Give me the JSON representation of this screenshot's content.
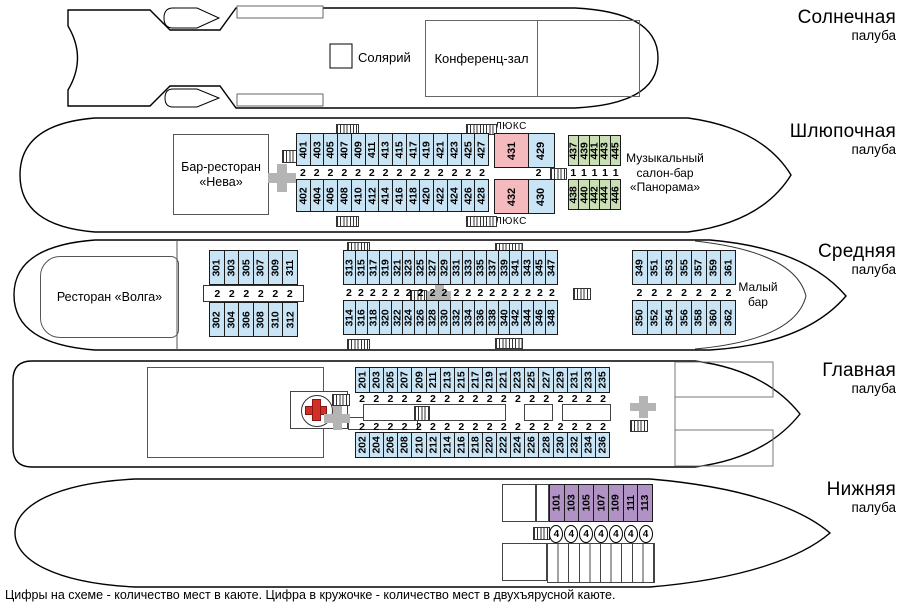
{
  "caption": "Цифры на схеме - количество мест в каюте. Цифра в кружочке - количество мест в двухъярусной каюте.",
  "decks": {
    "sun": {
      "name": "Солнечная",
      "sub": "палуба",
      "solarium_label": "Солярий",
      "conference_label": "Конференц-зал"
    },
    "boat": {
      "name": "Шлюпочная",
      "sub": "палуба",
      "bar_line1": "Бар-ресторан",
      "bar_line2": "«Нева»",
      "lux_label_top": "ЛЮКС",
      "lux_label_bottom": "ЛЮКС",
      "music_line1": "Музыкальный",
      "music_line2": "салон-бар",
      "music_line3": "«Панорама»",
      "cabins_top": [
        "401",
        "403",
        "405",
        "407",
        "409",
        "411",
        "413",
        "415",
        "417",
        "419",
        "421",
        "423",
        "425",
        "427"
      ],
      "cabins_bottom": [
        "402",
        "404",
        "406",
        "408",
        "410",
        "412",
        "414",
        "416",
        "418",
        "420",
        "422",
        "424",
        "426",
        "428"
      ],
      "lux_top": "431",
      "lux_bottom": "432",
      "cabin_429": "429",
      "cabin_430": "430",
      "green_top": [
        "437",
        "439",
        "441",
        "443",
        "445"
      ],
      "green_bottom": [
        "438",
        "440",
        "442",
        "444",
        "446"
      ],
      "cap_standard": "2",
      "cap_green": "1"
    },
    "middle": {
      "name": "Средняя",
      "sub": "палуба",
      "restaurant_label": "Ресторан «Волга»",
      "maly_line1": "Малый",
      "maly_line2": "бар",
      "aft_top": [
        "301",
        "303",
        "305",
        "307",
        "309",
        "311"
      ],
      "aft_bottom": [
        "302",
        "304",
        "306",
        "308",
        "310",
        "312"
      ],
      "mid_top": [
        "313",
        "315",
        "317",
        "319",
        "321",
        "323",
        "325",
        "327",
        "329",
        "331",
        "333",
        "335",
        "337",
        "339",
        "341",
        "343",
        "345",
        "347"
      ],
      "mid_bottom": [
        "314",
        "316",
        "318",
        "320",
        "322",
        "324",
        "326",
        "328",
        "330",
        "332",
        "334",
        "336",
        "338",
        "340",
        "342",
        "344",
        "346",
        "348"
      ],
      "fwd_top": [
        "349",
        "351",
        "353",
        "355",
        "357",
        "359",
        "361"
      ],
      "fwd_bottom": [
        "350",
        "352",
        "354",
        "356",
        "358",
        "360",
        "362"
      ],
      "cap_standard": "2"
    },
    "main": {
      "name": "Главная",
      "sub": "палуба",
      "cabins_top": [
        "201",
        "203",
        "205",
        "207",
        "209",
        "211",
        "213",
        "215",
        "217",
        "219",
        "221",
        "223",
        "225",
        "227",
        "229",
        "231",
        "233",
        "235"
      ],
      "cabins_bottom": [
        "202",
        "204",
        "206",
        "208",
        "210",
        "212",
        "214",
        "216",
        "218",
        "220",
        "222",
        "224",
        "226",
        "228",
        "230",
        "232",
        "234",
        "236"
      ],
      "cap_standard": "2"
    },
    "lower": {
      "name": "Нижняя",
      "sub": "палуба",
      "cabins": [
        "101",
        "103",
        "105",
        "107",
        "109",
        "111",
        "113"
      ],
      "cap_bunk": "4"
    }
  },
  "colors": {
    "cabin_standard": "#c9e4f5",
    "cabin_lux": "#f4babd",
    "cabin_single": "#cadfb6",
    "cabin_bunk": "#b192c5"
  }
}
